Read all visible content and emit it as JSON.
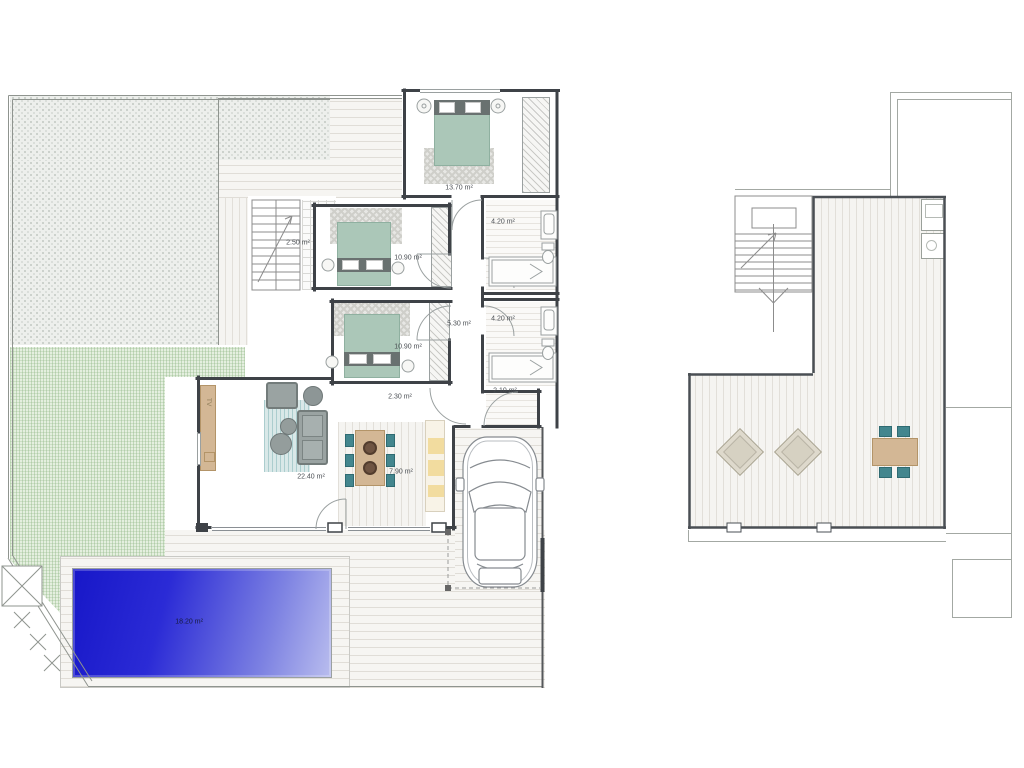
{
  "ground": {
    "rooms": {
      "bedroom1": "13.70 m²",
      "stair_hall": "2.50 m²",
      "bedroom2": "10.90 m²",
      "bathroom1": "4.20 m²",
      "hallway": "5.30 m²",
      "bathroom2": "4.20 m²",
      "bedroom3": "10.90 m²",
      "inner_hall": "2.30 m²",
      "porch": "2.10 m²",
      "living_room": "22.40 m²",
      "kitchen_dining": "7.90 m²",
      "pool": "18.20 m²"
    },
    "tv_unit": "TV"
  },
  "colors": {
    "wall": "#3e4247",
    "bed_green": "#abc7b8",
    "chair_teal": "#43868e",
    "table_tan": "#d3b795",
    "sofa_gray": "#9aa3a2",
    "pool_blue": "#2b2bd6",
    "grass_green": "#e4efdf",
    "gravel_gray": "#edefec"
  }
}
